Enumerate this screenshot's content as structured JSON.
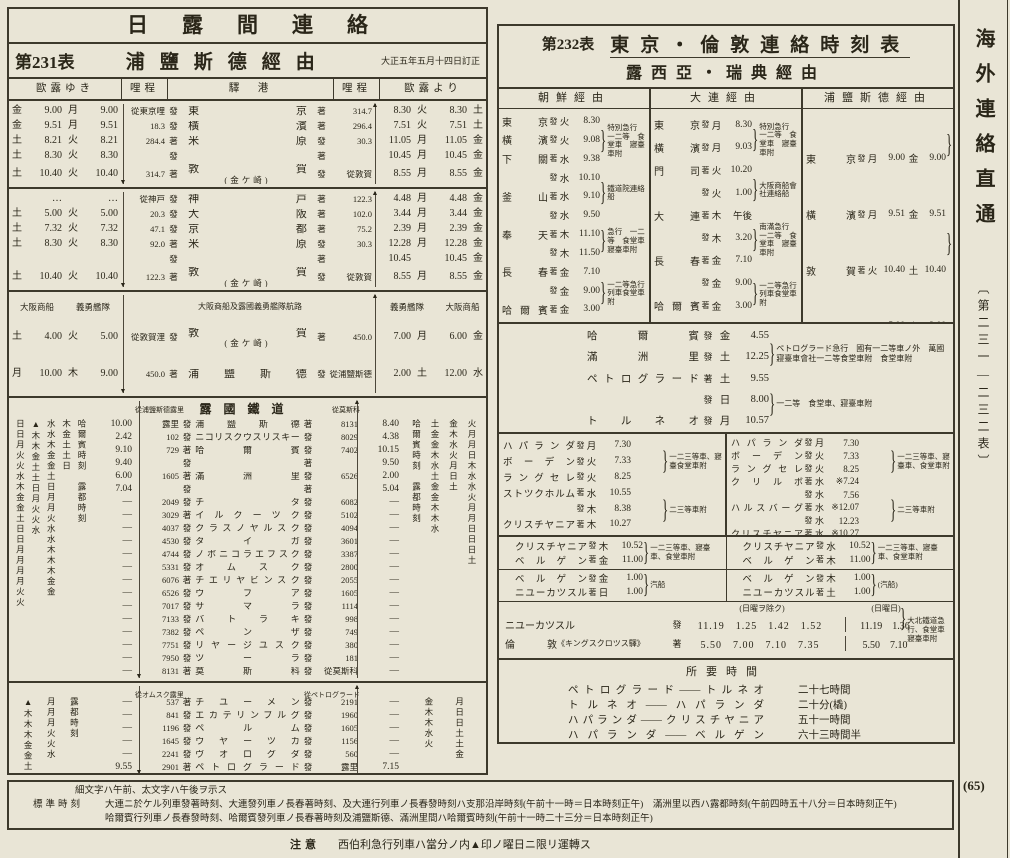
{
  "page": {
    "number": "(65)"
  },
  "margin": {
    "title": "海外連絡直通",
    "range": "〔第二三一—二三二表〕"
  },
  "notes": {
    "legend": "細文字ハ午前、太文字ハ午後ヲ示ス",
    "std_label": "標準時刻",
    "std_line1": "大連ニ於ケル列車發著時刻、大連發列車ノ長春著時刻、及大連行列車ノ長春發時刻ハ支那沿岸時刻(午前十一時＝日本時刻正午)",
    "std_line1b": "滿洲里以西ハ露都時刻(午前四時五十八分＝日本時刻正午)",
    "std_line2": "哈爾賓行列車ノ長春發時刻、哈爾賓發列車ノ長春著時刻及浦鹽斯德、滿洲里間ハ哈爾賓時刻(午前十一時二十三分＝日本時刻正午)",
    "caution_label": "注意",
    "caution": "西伯利急行列車ハ當分ノ内▲印ノ曜日ニ限リ運轉ス"
  },
  "left_table": {
    "group_title": "日露間連絡",
    "table_no": "第231表",
    "route_title": "浦鹽斯德經由",
    "revision": "大正五年五月十四日訂正",
    "headers": {
      "go": "歐露ゆき",
      "km": "哩程",
      "station": "驛　港",
      "km2": "哩程",
      "ret": "歐露より"
    },
    "sec_tokyo": {
      "rows": [
        {
          "d1": "金",
          "t1": "9.00",
          "d2": "月",
          "t2": "9.00",
          "kd": "從東京哩",
          "m1": "發",
          "st": "東京",
          "sub": "",
          "m2": "著",
          "ku": "314.7",
          "t3": "8.30",
          "d3": "火",
          "t4": "8.30",
          "d4": "土"
        },
        {
          "d1": "金",
          "t1": "9.51",
          "d2": "月",
          "t2": "9.51",
          "kd": "18.3",
          "m1": "發",
          "st": "橫濱",
          "sub": "",
          "m2": "著",
          "ku": "296.4",
          "t3": "7.51",
          "d3": "火",
          "t4": "7.51",
          "d4": "土"
        },
        {
          "d1": "土",
          "t1": "8.21",
          "d2": "火",
          "t2": "8.21",
          "kd": "284.4",
          "m1": "著",
          "st": "米原",
          "sub": "",
          "m2": "發",
          "ku": "30.3",
          "t3": "11.05",
          "d3": "月",
          "t4": "11.05",
          "d4": "金"
        },
        {
          "d1": "土",
          "t1": "8.30",
          "d2": "火",
          "t2": "8.30",
          "kd": "",
          "m1": "發",
          "st": "",
          "sub": "",
          "m2": "著",
          "ku": "",
          "t3": "10.45",
          "d3": "月",
          "t4": "10.45",
          "d4": "金"
        },
        {
          "d1": "土",
          "t1": "10.40",
          "d2": "火",
          "t2": "10.40",
          "kd": "314.7",
          "m1": "著",
          "st": "敦賀",
          "sub": "(金ケ崎)",
          "m2": "發",
          "ku": "從敦賀",
          "t3": "8.55",
          "d3": "月",
          "t4": "8.55",
          "d4": "金"
        }
      ]
    },
    "sec_kobe": {
      "rows": [
        {
          "d1": "",
          "t1": "…",
          "d2": "",
          "t2": "…",
          "kd": "從神戸",
          "m1": "發",
          "st": "神戸",
          "sub": "",
          "m2": "著",
          "ku": "122.3",
          "t3": "4.48",
          "d3": "月",
          "t4": "4.48",
          "d4": "金"
        },
        {
          "d1": "土",
          "t1": "5.00",
          "d2": "火",
          "t2": "5.00",
          "kd": "20.3",
          "m1": "發",
          "st": "大阪",
          "sub": "",
          "m2": "著",
          "ku": "102.0",
          "t3": "3.44",
          "d3": "月",
          "t4": "3.44",
          "d4": "金"
        },
        {
          "d1": "土",
          "t1": "7.32",
          "d2": "火",
          "t2": "7.32",
          "kd": "47.1",
          "m1": "發",
          "st": "京都",
          "sub": "",
          "m2": "著",
          "ku": "75.2",
          "t3": "2.39",
          "d3": "月",
          "t4": "2.39",
          "d4": "金"
        },
        {
          "d1": "土",
          "t1": "8.30",
          "d2": "火",
          "t2": "8.30",
          "kd": "92.0",
          "m1": "著",
          "st": "米原",
          "sub": "",
          "m2": "發",
          "ku": "30.3",
          "t3": "12.28",
          "d3": "月",
          "t4": "12.28",
          "d4": "金"
        },
        {
          "d1": "",
          "t1": "",
          "d2": "",
          "t2": "",
          "kd": "",
          "m1": "發",
          "st": "",
          "sub": "",
          "m2": "著",
          "ku": "",
          "t3": "10.45",
          "d3": "",
          "t4": "10.45",
          "d4": "金"
        },
        {
          "d1": "土",
          "t1": "10.40",
          "d2": "火",
          "t2": "10.40",
          "kd": "122.3",
          "m1": "著",
          "st": "敦賀",
          "sub": "(金ケ崎)",
          "m2": "發",
          "ku": "從敦賀",
          "t3": "8.55",
          "d3": "月",
          "t4": "8.55",
          "d4": "金"
        }
      ]
    },
    "sea": {
      "co1": "大阪商船",
      "co2": "義勇艦隊",
      "route_label": "大阪商船及露國義勇艦隊航路",
      "rows": [
        {
          "d1": "土",
          "t1": "4.00",
          "d2": "火",
          "t2": "5.00",
          "kd": "從敦賀浬",
          "m1": "發",
          "st": "敦賀",
          "sub": "(金ケ崎)",
          "m2": "著",
          "ku": "450.0",
          "t3": "7.00",
          "d3": "月",
          "t4": "6.00",
          "d4": "金"
        },
        {
          "d1": "月",
          "t1": "10.00",
          "d2": "木",
          "t2": "9.00",
          "kd": "450.0",
          "m1": "著",
          "st": "浦鹽斯德",
          "sub": "",
          "m2": "發",
          "ku": "從浦鹽斯德",
          "t3": "2.00",
          "d3": "土",
          "t4": "12.00",
          "d4": "水"
        }
      ]
    },
    "ru1": {
      "title": "露國鐵道",
      "km_label": "從浦鹽斯德露里",
      "km_label_r": "從莫斯科",
      "day_cols_left": [
        "日日月火火水木金金土日日月月月月火火",
        "▲木木金土土日月火火水",
        "水水木金金土日月月火水水木木木金金",
        "木金土土日",
        "哈爾賓時刻　露都時刻"
      ],
      "day_cols_right": [
        "哈爾賓時刻　露都時刻",
        "土金金木水土金金木木水",
        "金木水火月日土",
        "火月月日木水水火月月日日日土"
      ],
      "rows": [
        {
          "t1": "10.00",
          "kd": "露里",
          "m1": "發",
          "st": "浦鹽斯德",
          "m2": "著",
          "ku": "8131",
          "t2": "8.40"
        },
        {
          "t1": "2.42",
          "kd": "102",
          "m1": "發",
          "st": "ニコリスクウスリスキー",
          "m2": "發",
          "ku": "8029",
          "t2": "4.38"
        },
        {
          "t1": "9.10",
          "kd": "729",
          "m1": "著",
          "st": "哈爾賓",
          "m2": "發",
          "ku": "7402",
          "t2": "10.15"
        },
        {
          "t1": "9.40",
          "kd": "",
          "m1": "發",
          "st": "",
          "m2": "著",
          "ku": "",
          "t2": "9.50"
        },
        {
          "t1": "6.00",
          "kd": "1605",
          "m1": "著",
          "st": "滿洲里",
          "m2": "發",
          "ku": "6526",
          "t2": "2.00"
        },
        {
          "t1": "7.04",
          "kd": "",
          "m1": "發",
          "st": "",
          "m2": "著",
          "ku": "",
          "t2": "5.04"
        },
        {
          "t1": "―",
          "kd": "2049",
          "m1": "發",
          "st": "チタ",
          "m2": "發",
          "ku": "6082",
          "t2": "―"
        },
        {
          "t1": "―",
          "kd": "3029",
          "m1": "著",
          "st": "イルクーツク",
          "m2": "發",
          "ku": "5102",
          "t2": "―"
        },
        {
          "t1": "―",
          "kd": "4037",
          "m1": "發",
          "st": "クラスノヤルスク",
          "m2": "發",
          "ku": "4094",
          "t2": "―"
        },
        {
          "t1": "―",
          "kd": "4530",
          "m1": "發",
          "st": "タイガ",
          "m2": "發",
          "ku": "3601",
          "t2": "―"
        },
        {
          "t1": "―",
          "kd": "4744",
          "m1": "發",
          "st": "ノボニコラエフスク",
          "m2": "發",
          "ku": "3387",
          "t2": "―"
        },
        {
          "t1": "―",
          "kd": "5331",
          "m1": "發",
          "st": "オムスク",
          "m2": "發",
          "ku": "2800",
          "t2": "―"
        },
        {
          "t1": "―",
          "kd": "6076",
          "m1": "著",
          "st": "チエリヤビンスク",
          "m2": "發",
          "ku": "2055",
          "t2": "―"
        },
        {
          "t1": "―",
          "kd": "6526",
          "m1": "發",
          "st": "ウフア",
          "m2": "發",
          "ku": "1605",
          "t2": "―"
        },
        {
          "t1": "―",
          "kd": "7017",
          "m1": "發",
          "st": "サマラ",
          "m2": "發",
          "ku": "1114",
          "t2": "―"
        },
        {
          "t1": "―",
          "kd": "7133",
          "m1": "發",
          "st": "バトラキ",
          "m2": "發",
          "ku": "998",
          "t2": "―"
        },
        {
          "t1": "―",
          "kd": "7382",
          "m1": "發",
          "st": "ペンザ",
          "m2": "發",
          "ku": "749",
          "t2": "―"
        },
        {
          "t1": "―",
          "kd": "7751",
          "m1": "發",
          "st": "リヤージユスク",
          "m2": "發",
          "ku": "380",
          "t2": "―"
        },
        {
          "t1": "―",
          "kd": "7950",
          "m1": "發",
          "st": "ツーラ",
          "m2": "發",
          "ku": "181",
          "t2": "―"
        },
        {
          "t1": "―",
          "kd": "8131",
          "m1": "著",
          "st": "莫斯科",
          "m2": "發",
          "ku": "從莫斯科",
          "t2": "―"
        }
      ]
    },
    "ru2": {
      "km_label": "從オムスク露里",
      "km_label_r": "從ペトログラード",
      "day_cols_left": [
        "▲木木木金金土",
        "月月月火火水",
        "露都時刻"
      ],
      "day_cols_right": [
        "金木木水火",
        "月日日土土金"
      ],
      "rows": [
        {
          "t1": "―",
          "kd": "537",
          "m1": "著",
          "st": "チユーメン",
          "m2": "發",
          "ku": "2191",
          "t2": "―"
        },
        {
          "t1": "―",
          "kd": "841",
          "m1": "發",
          "st": "エカテリンブルグ",
          "m2": "發",
          "ku": "1960",
          "t2": "―"
        },
        {
          "t1": "―",
          "kd": "1196",
          "m1": "發",
          "st": "ペルム",
          "m2": "發",
          "ku": "1605",
          "t2": "―"
        },
        {
          "t1": "―",
          "kd": "1645",
          "m1": "發",
          "st": "ウヤーツカ",
          "m2": "發",
          "ku": "1156",
          "t2": "―"
        },
        {
          "t1": "―",
          "kd": "2241",
          "m1": "發",
          "st": "ヴオログダ",
          "m2": "發",
          "ku": "560",
          "t2": "―"
        },
        {
          "t1": "9.55",
          "kd": "2901",
          "m1": "著",
          "st": "ペトログラード",
          "m2": "發",
          "ku": "露里",
          "t2": "7.15"
        }
      ]
    }
  },
  "right_table": {
    "table_no": "第232表",
    "title": "東京・倫敦連絡時刻表",
    "subtitle": "露西亞・瑞典經由",
    "route_a": {
      "name": "朝鮮經由",
      "rows": [
        {
          "st": "東京",
          "m": "發",
          "d": "火",
          "t": "8.30"
        },
        {
          "st": "橫濱",
          "m": "發",
          "d": "火",
          "t": "9.08"
        },
        {
          "st": "下關",
          "m": "著",
          "d": "水",
          "t": "9.38"
        },
        {
          "st": "",
          "m": "發",
          "d": "水",
          "t": "10.10"
        },
        {
          "st": "釜山",
          "m": "著",
          "d": "水",
          "t": "9.10"
        },
        {
          "st": "",
          "m": "發",
          "d": "水",
          "t": "9.50"
        },
        {
          "st": "奉天",
          "m": "著",
          "d": "木",
          "t": "11.10"
        },
        {
          "st": "",
          "m": "發",
          "d": "木",
          "t": "11.50"
        },
        {
          "st": "長春",
          "m": "著",
          "d": "金",
          "t": "7.10"
        },
        {
          "st": "",
          "m": "發",
          "d": "金",
          "t": "9.00"
        },
        {
          "st": "哈爾賓",
          "m": "著",
          "d": "金",
          "t": "3.00"
        }
      ],
      "notes": [
        "特別急行　一二等　食堂車　寢臺車附",
        "鐵道院連絡船",
        "急行　一二等　食堂車　寢臺車附",
        "一二等急行列車食堂車附"
      ]
    },
    "route_b": {
      "name": "大連經由",
      "rows": [
        {
          "st": "東京",
          "m": "發",
          "d": "月",
          "t": "8.30"
        },
        {
          "st": "橫濱",
          "m": "發",
          "d": "月",
          "t": "9.03"
        },
        {
          "st": "門司",
          "m": "著",
          "d": "火",
          "t": "10.20"
        },
        {
          "st": "",
          "m": "發",
          "d": "火",
          "t": "1.00"
        },
        {
          "st": "大連",
          "m": "著",
          "d": "木",
          "t": "午後"
        },
        {
          "st": "",
          "m": "發",
          "d": "木",
          "t": "3.20"
        },
        {
          "st": "長春",
          "m": "著",
          "d": "金",
          "t": "7.10"
        },
        {
          "st": "",
          "m": "發",
          "d": "金",
          "t": "9.00"
        },
        {
          "st": "哈爾賓",
          "m": "著",
          "d": "金",
          "t": "3.00"
        }
      ],
      "notes": [
        "特別急行　一二等　食堂車　寢臺車附",
        "大阪商船會社連絡船",
        "南滿急行　一二等　食堂車　寢臺車附",
        "一二等急行列車食堂車附"
      ]
    },
    "route_c": {
      "name": "浦鹽斯德經由",
      "rows": [
        {
          "st": "東京",
          "m": "發",
          "d1": "月",
          "t1": "9.00",
          "d2": "金",
          "t2": "9.00"
        },
        {
          "st": "橫濱",
          "m": "發",
          "d1": "月",
          "t1": "9.51",
          "d2": "金",
          "t2": "9.51"
        },
        {
          "st": "敦賀",
          "m": "著",
          "d1": "火",
          "t1": "10.40",
          "d2": "土",
          "t2": "10.40"
        },
        {
          "st": "",
          "m": "發",
          "d1": "火",
          "t1": "5.00",
          "d2": "土",
          "t2": "2.00"
        },
        {
          "st": "浦鹽斯德",
          "m": "著",
          "d1": "木",
          "t1": "9.00",
          "d2": "月",
          "t2": "10.00"
        },
        {
          "st": "",
          "m": "發",
          "d1": "木",
          "t1": "8.00",
          "d2": "",
          "t2": ""
        },
        {
          "st": "哈爾賓",
          "m": "著",
          "d1": "金",
          "t1": "4.25",
          "d2": "",
          "t2": ""
        }
      ],
      "notes": [
        "直通列車　一二等　食堂車　寢臺車附",
        "露國義勇艦隊大阪商船會社連絡船",
        "ペトログラード急行　國有一二等車ノ分",
        "萬國寢臺車會社一二等食堂車附",
        "食堂車附"
      ]
    },
    "mid": {
      "rows": [
        {
          "st": "哈爾賓",
          "m": "發",
          "d": "金",
          "t": "4.55"
        },
        {
          "st": "滿洲里",
          "m": "發",
          "d": "土",
          "t": "12.25"
        },
        {
          "st": "ペトログラード",
          "m": "著",
          "d": "土",
          "t": "9.55"
        },
        {
          "st": "",
          "m": "發",
          "d": "日",
          "t": "8.00"
        },
        {
          "st": "トルネオ",
          "m": "發",
          "d": "月",
          "t": "10.57"
        }
      ],
      "notes": [
        "ペトログラード急行　國有一二等車ノ外　萬國寢臺車會社一二等食堂車附　食堂車附",
        "一二等　食堂車、寢臺車附"
      ]
    },
    "scand_left": {
      "rows": [
        {
          "st": "ハパランダ",
          "m": "發",
          "d": "月",
          "t": "7.30"
        },
        {
          "st": "ボーデン",
          "m": "發",
          "d": "火",
          "t": "7.33"
        },
        {
          "st": "ラングセレ",
          "m": "發",
          "d": "火",
          "t": "8.25"
        },
        {
          "st": "ストツクホルム",
          "m": "著",
          "d": "水",
          "t": "10.55"
        },
        {
          "st": "",
          "m": "發",
          "d": "木",
          "t": "8.38"
        },
        {
          "st": "クリスチヤニア",
          "m": "著",
          "d": "木",
          "t": "10.27"
        }
      ],
      "notes": [
        "一二三等車、寢臺食堂車附",
        "二三等車附"
      ]
    },
    "scand_right": {
      "rows": [
        {
          "st": "ハパランダ",
          "m": "發",
          "d": "月",
          "t": "7.30"
        },
        {
          "st": "ボーデン",
          "m": "發",
          "d": "火",
          "t": "7.33"
        },
        {
          "st": "ラングセレ",
          "m": "發",
          "d": "火",
          "t": "8.25"
        },
        {
          "st": "クリルボ",
          "m": "著",
          "d": "水",
          "t": "※7.24"
        },
        {
          "st": "",
          "m": "發",
          "d": "水",
          "t": "7.56"
        },
        {
          "st": "ハルスバーグ",
          "m": "著",
          "d": "水",
          "t": "※12.07"
        },
        {
          "st": "",
          "m": "發",
          "d": "水",
          "t": "12.23"
        },
        {
          "st": "クリスチヤニア",
          "m": "著",
          "d": "水",
          "t": "※10.27"
        }
      ],
      "notes": [
        "一二三等車、寢臺車、食堂車附",
        "二三等車附"
      ]
    },
    "norway_left": {
      "rows": [
        {
          "st": "クリスチヤニア",
          "m": "發",
          "d": "木",
          "t": "10.52"
        },
        {
          "st": "ベルゲン",
          "m": "著",
          "d": "金",
          "t": "11.00"
        }
      ],
      "note": "一二三等車、寢臺車、食堂車附"
    },
    "norway_right": {
      "rows": [
        {
          "st": "クリスチヤニア",
          "m": "發",
          "d": "水",
          "t": "10.52"
        },
        {
          "st": "ベルゲン",
          "m": "著",
          "d": "木",
          "t": "11.00"
        }
      ],
      "note": "一二三等車、寢臺車、食堂車附"
    },
    "steamer_left": {
      "rows": [
        {
          "st": "ベルゲン",
          "m": "發",
          "d": "金",
          "t": "1.00"
        },
        {
          "st": "ニユーカツスル",
          "m": "著",
          "d": "日",
          "t": "1.00"
        }
      ],
      "note": "汽船"
    },
    "steamer_right": {
      "rows": [
        {
          "st": "ベルゲン",
          "m": "發",
          "d": "木",
          "t": "1.00"
        },
        {
          "st": "ニユーカツスル",
          "m": "著",
          "d": "土",
          "t": "1.00"
        }
      ],
      "note": "(汽船)"
    },
    "england": {
      "weekday_label": "(日曜ヲ除ク)",
      "sunday_label": "(日曜日)",
      "rows": [
        {
          "st": "ニユーカツスル",
          "suffix": "",
          "m": "發",
          "wk": [
            "11.19",
            "1.25",
            "1.42",
            "1.52"
          ],
          "su": [
            "11.19",
            "1.36"
          ]
        },
        {
          "st": "倫敦",
          "suffix": "《キングスクロツス驛》",
          "m": "著",
          "wk": [
            "5.50",
            "7.00",
            "7.10",
            "7.35"
          ],
          "su": [
            "5.50",
            "7.10"
          ]
        }
      ],
      "note": "大北鐵道急行、食堂車寢臺車附"
    },
    "durations": {
      "title": "所要時間",
      "rows": [
        {
          "route": "ペトログラード——トルネオ",
          "time": "二十七時間"
        },
        {
          "route": "トルネオ——ハパランダ",
          "time": "二十分(橇)"
        },
        {
          "route": "ハパランダ——クリスチヤニア",
          "time": "五十一時間"
        },
        {
          "route": "ハパランダ——ベルゲン",
          "time": "六十三時間半"
        }
      ]
    }
  }
}
